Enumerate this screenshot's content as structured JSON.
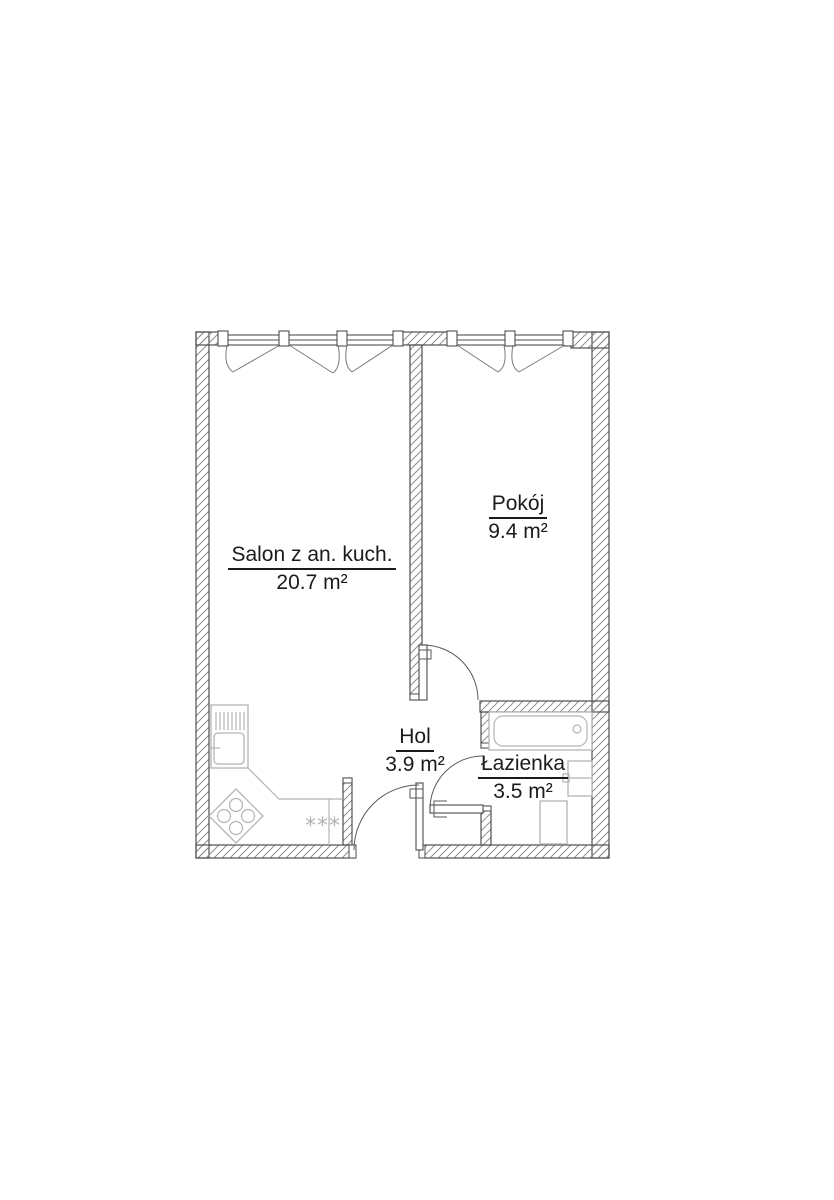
{
  "plan": {
    "colors": {
      "background": "#ffffff",
      "line": "#4f4f4f",
      "hatch": "#8f8f8f",
      "door": "#5a5a5a",
      "furniture": "#b3b3b3",
      "symbol": "#7a7a7a",
      "text": "#1b1b1b"
    },
    "rooms": [
      {
        "id": "salon",
        "name": "Salon z an. kuch.",
        "area": "20.7 m²"
      },
      {
        "id": "pokoj",
        "name": "Pokój",
        "area": "9.4 m²"
      },
      {
        "id": "hol",
        "name": "Hol",
        "area": "3.9 m²"
      },
      {
        "id": "lazienka",
        "name": "Łazienka",
        "area": "3.5 m²"
      }
    ],
    "kitchen_marking": "***"
  }
}
